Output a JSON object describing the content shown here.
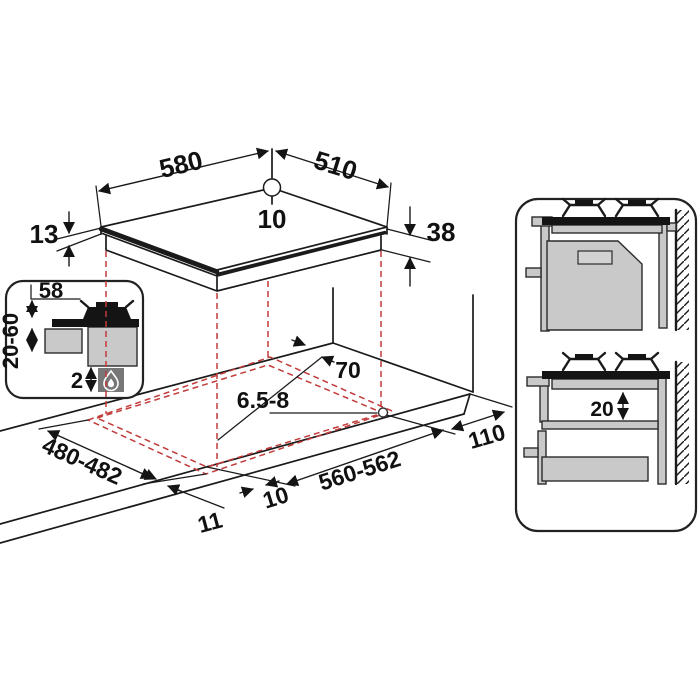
{
  "figure": {
    "type": "installation-diagram",
    "subject": "built-in gas hob cut-out and clearance dimensions"
  },
  "colors": {
    "line": "#1a1a1a",
    "accent_red": "#c23b3b",
    "fill_gray": "#c9c9c9",
    "fill_dark": "#141414",
    "flame_box": "#777777"
  },
  "dimensions": {
    "hob_width": "580",
    "hob_depth": "510",
    "hole_edge_offset": "10",
    "lip_thickness": "13",
    "body_depth": "38",
    "burner_offset": "58",
    "worktop_thickness_range": "20-60",
    "clearance_below": "2",
    "rear_clearance": "70",
    "fixing_hole_diameter": "6.5-8",
    "right_clearance": "110",
    "cutout_width": "560-562",
    "cutout_depth": "480-482",
    "front_overlap": "10",
    "side_overlap": "11",
    "shelf_clearance": "20"
  },
  "icons": {
    "gas_flame": "gas-flame-icon"
  }
}
